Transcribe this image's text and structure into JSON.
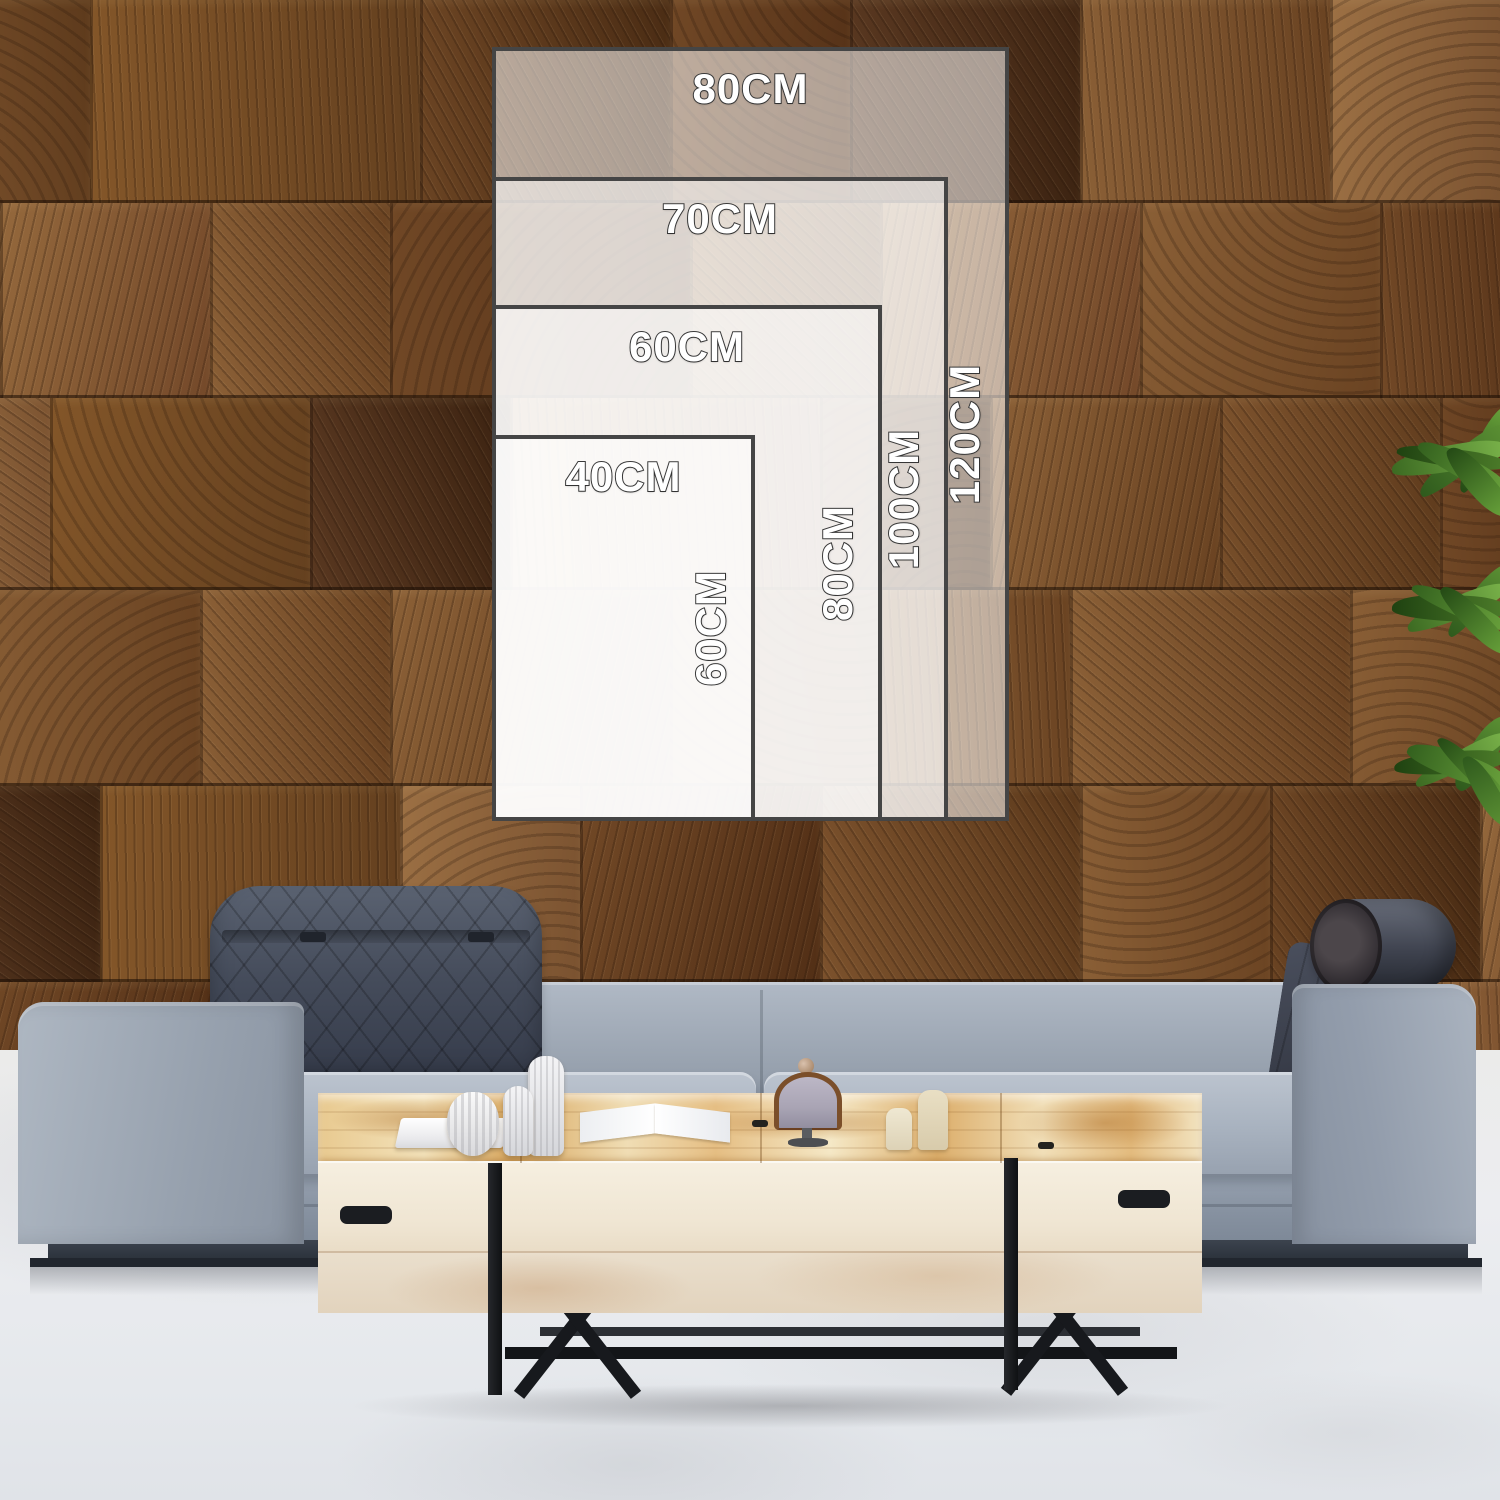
{
  "size_guide": {
    "unit": "CM",
    "sizes": [
      {
        "id": "80x120",
        "width_cm": 80,
        "height_cm": 120,
        "width_label": "80CM",
        "height_label": "120CM"
      },
      {
        "id": "70x100",
        "width_cm": 70,
        "height_cm": 100,
        "width_label": "70CM",
        "height_label": "100CM"
      },
      {
        "id": "60x80",
        "width_cm": 60,
        "height_cm": 80,
        "width_label": "60CM",
        "height_label": "80CM"
      },
      {
        "id": "40x60",
        "width_cm": 40,
        "height_cm": 60,
        "width_label": "40CM",
        "height_label": "60CM"
      }
    ],
    "overlay_fill": "rgba(255,255,255,0.55)",
    "overlay_border": "#454545",
    "label_color": "#ffffff",
    "label_outline": "#3c3c3c"
  },
  "scene": {
    "description": "living room mockup",
    "wall": {
      "material": "end-grain wood blocks",
      "color_mid": "#7b512c",
      "color_dark": "#4a2c14",
      "color_light": "#9a6c3e"
    },
    "floor": {
      "material": "white concrete",
      "color": "#ebedf0"
    },
    "sofa": {
      "fabric_color": "#9fa9b6",
      "headrest_color": "#3e4553",
      "base_color": "#293039"
    },
    "coffee_table": {
      "top_wood_color": "#eccf9a",
      "front_color": "#f2e9d8",
      "leg_color": "#17191d"
    },
    "plant": {
      "leaf_color": "#55892f"
    }
  }
}
